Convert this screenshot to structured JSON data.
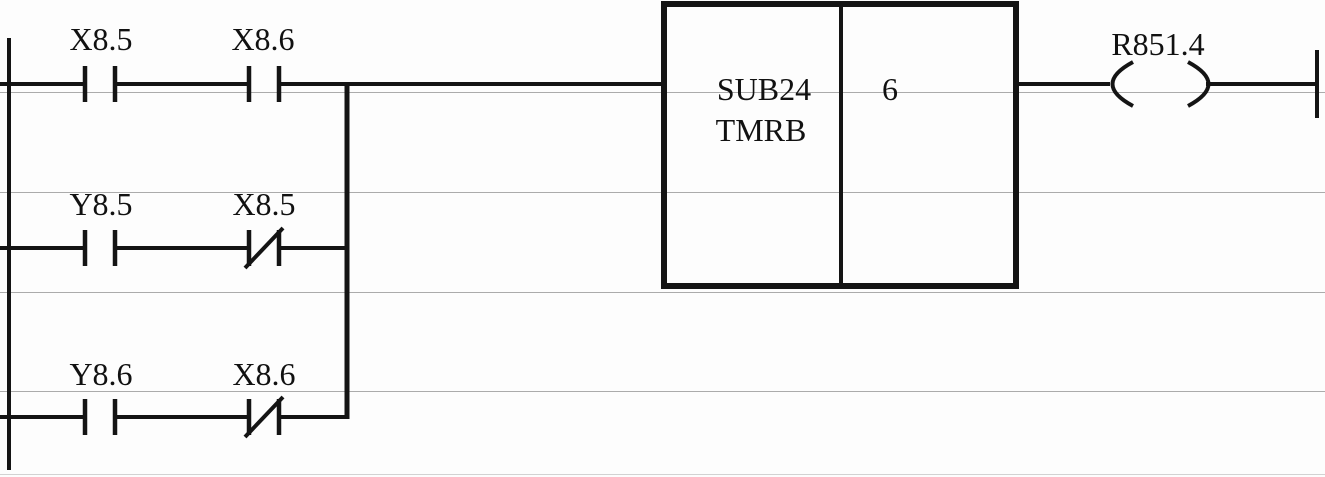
{
  "diagram": {
    "kind": "plc-ladder-logic",
    "colors": {
      "wire": "#141414",
      "grid": "#ababab",
      "background": "#fdfdfd",
      "text": "#111111"
    }
  },
  "ladder": {
    "main_rung": {
      "contacts": [
        {
          "label": "X8.5",
          "type": "normally-open"
        },
        {
          "label": "X8.6",
          "type": "normally-open"
        }
      ],
      "function_block": {
        "line1": "SUB24",
        "line2": "TMRB",
        "parameter": "6"
      },
      "coil": {
        "label": "R851.4"
      }
    },
    "branches": [
      {
        "contacts": [
          {
            "label": "Y8.5",
            "type": "normally-open"
          },
          {
            "label": "X8.5",
            "type": "normally-closed"
          }
        ]
      },
      {
        "contacts": [
          {
            "label": "Y8.6",
            "type": "normally-open"
          },
          {
            "label": "X8.6",
            "type": "normally-closed"
          }
        ]
      }
    ]
  }
}
